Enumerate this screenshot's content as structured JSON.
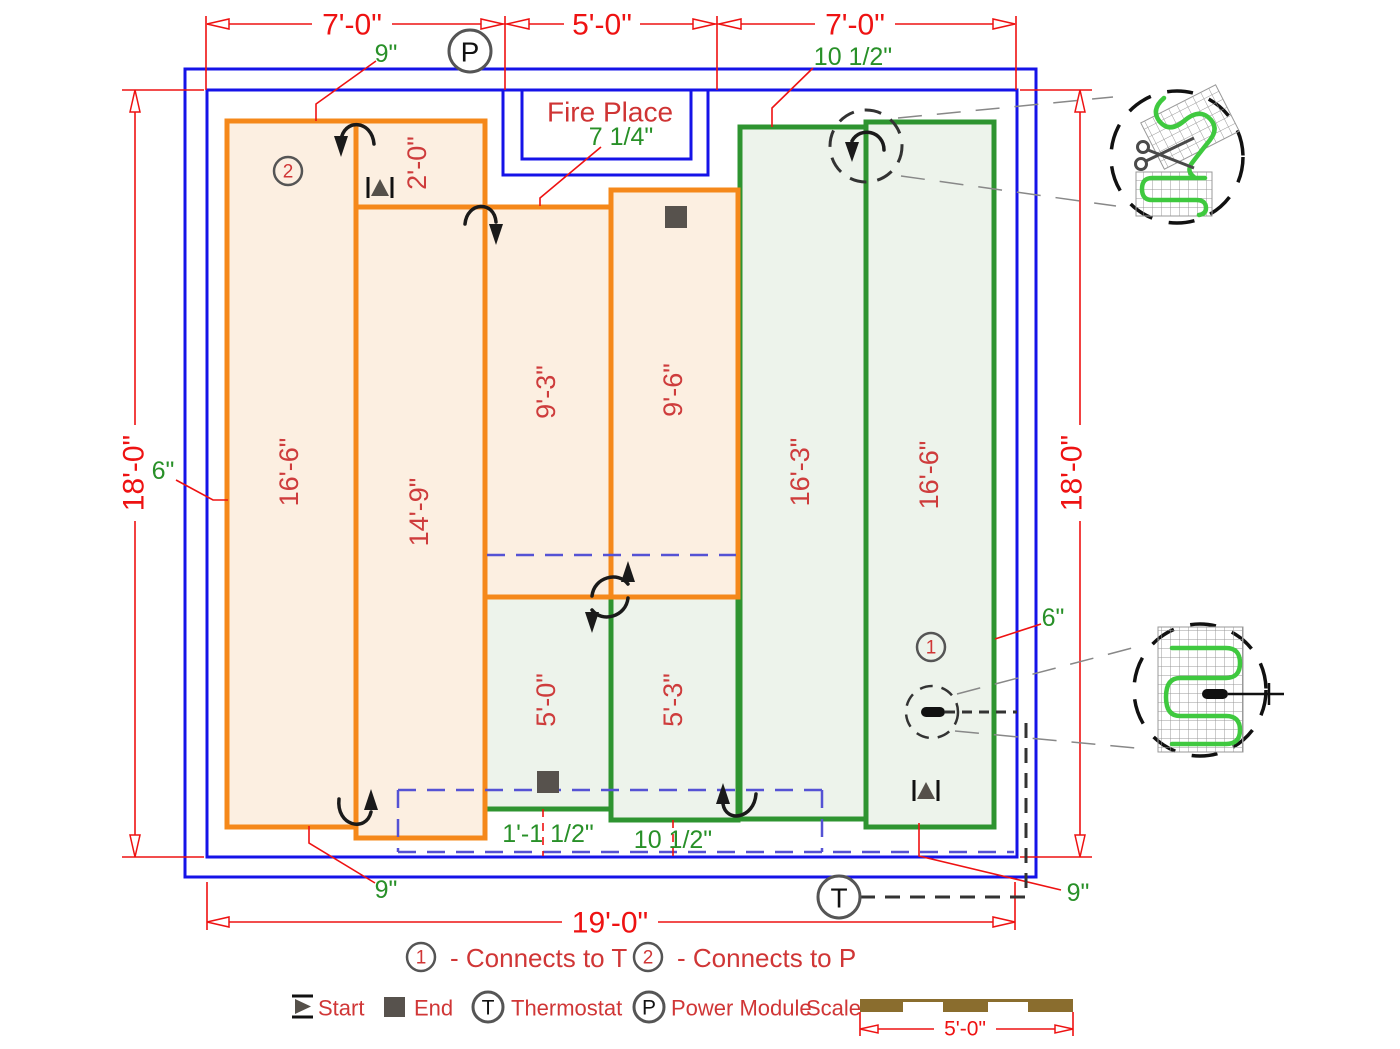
{
  "plan": {
    "fireplace_label": "Fire Place",
    "dims": {
      "top_left": "7'-0\"",
      "top_mid": "5'-0\"",
      "top_right": "7'-0\"",
      "left": "18'-0\"",
      "right": "18'-0\"",
      "bottom": "19'-0\""
    },
    "offsets": {
      "top_left": "9\"",
      "top_right": "10 1/2\"",
      "fireplace": "7 1/4\"",
      "left": "6\"",
      "right": "6\"",
      "bottom_left": "9\"",
      "bottom_right": "9\"",
      "lead_left": "1'-1 1/2\"",
      "lead_right": "10 1/2\""
    },
    "mats": {
      "orange": [
        {
          "length": "16'-6\""
        },
        {
          "length": "2'-0\""
        },
        {
          "length": "14'-9\""
        },
        {
          "length": "9'-3\""
        },
        {
          "length": "9'-6\""
        }
      ],
      "green": [
        {
          "length": "5'-0\""
        },
        {
          "length": "5'-3\""
        },
        {
          "length": "16'-3\""
        },
        {
          "length": "16'-6\""
        }
      ]
    },
    "markers": {
      "power": "P",
      "thermostat": "T",
      "connector1": "1",
      "connector2": "2"
    }
  },
  "legend": {
    "connect1_num": "1",
    "connect1_label": "- Connects to T",
    "connect2_num": "2",
    "connect2_label": "- Connects  to P",
    "start_label": "Start",
    "end_label": "End",
    "thermostat_symbol": "T",
    "thermostat_label": "Thermostat",
    "power_symbol": "P",
    "power_label": "Power Module",
    "scale_label": "Scale",
    "scale_dim": "5'-0\""
  },
  "colors": {
    "wall_blue": "#1513e8",
    "mat_orange": "#f5881a",
    "mat_orange_fill": "#fcefe1",
    "mat_green": "#2e9430",
    "mat_green_fill": "#edf3eb",
    "dimension_red": "#ee1212",
    "mat_label_red": "#ce3c3c",
    "offset_green": "#289028",
    "cold_lead_dashed_blue": "#5552d4",
    "detail_wire_green": "#3fc93f",
    "scale_bar_brown": "#8a6d2e"
  }
}
